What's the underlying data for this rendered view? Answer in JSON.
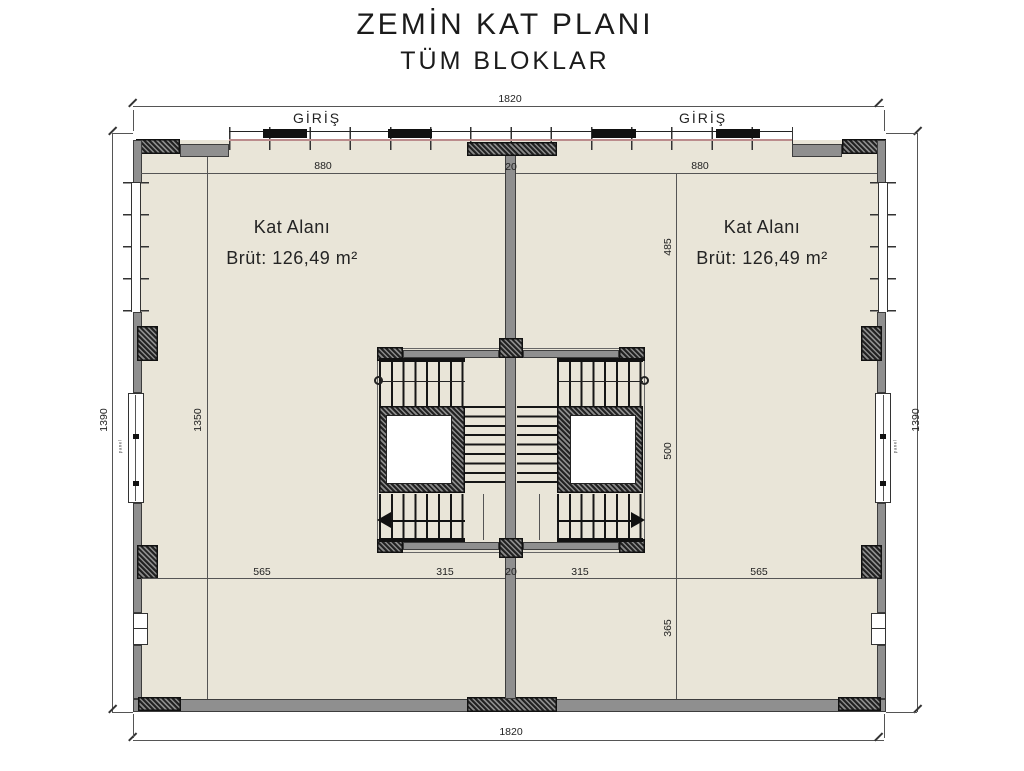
{
  "title": {
    "line1": "ZEMİN KAT PLANI",
    "line2": "TÜM BLOKLAR"
  },
  "entrances": {
    "left": "GİRİŞ",
    "right": "GİRİŞ"
  },
  "blocks": {
    "left": {
      "name": "Kat Alanı",
      "area": "Brüt: 126,49 m²"
    },
    "right": {
      "name": "Kat Alanı",
      "area": "Brüt: 126,49 m²"
    }
  },
  "dimensions": {
    "top_total": "1820",
    "bottom_total": "1820",
    "left_total": "1390",
    "right_total": "1390",
    "left_block_width": "880",
    "right_block_width": "880",
    "core_wall_top": "20",
    "left_block_height": "1350",
    "right_seg_upper": "485",
    "right_seg_mid": "500",
    "right_seg_lower": "365",
    "bottom_segs": [
      "565",
      "315",
      "20",
      "315",
      "565"
    ]
  },
  "annotations": {
    "door_note_left": "panel",
    "door_note_right": "panel"
  },
  "colors": {
    "floor": "#e9e5d8",
    "wall": "#8f8f8f",
    "hatch": "#222222",
    "dim_line": "#555555",
    "facade_line": "#bb8c8c",
    "ink": "#1b1b1b"
  }
}
